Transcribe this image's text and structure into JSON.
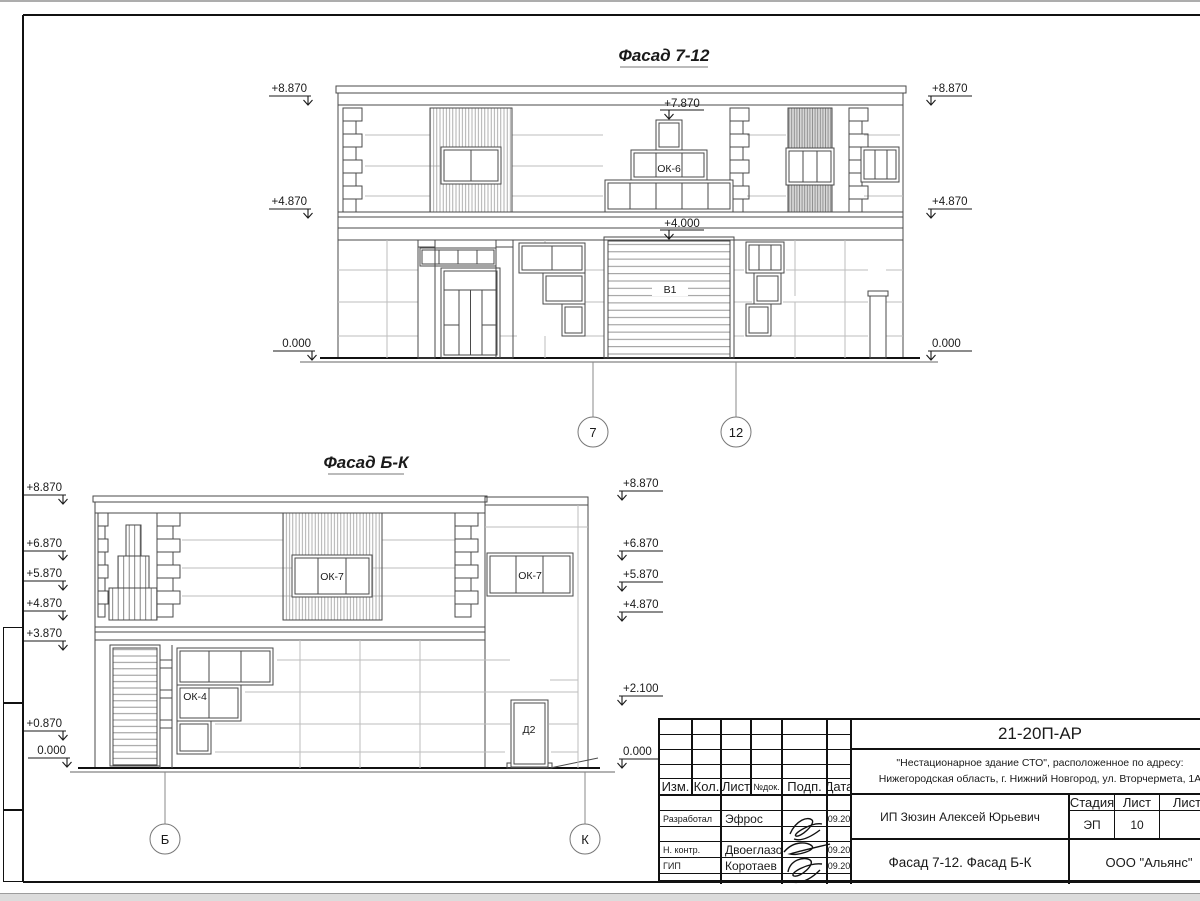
{
  "sheet": {
    "facade_7_12": {
      "title": "Фасад 7-12",
      "marks_left": [
        "+8.870",
        "+4.870",
        "0.000"
      ],
      "marks_right": [
        "+8.870",
        "+4.870",
        "0.000"
      ],
      "marks_mid": [
        "+7.870",
        "+4.000"
      ],
      "labels": {
        "window_pyramid": "ОК-6",
        "gate": "В1"
      },
      "axes": [
        "7",
        "12"
      ]
    },
    "facade_b_k": {
      "title": "Фасад Б-К",
      "marks_left": [
        "+8.870",
        "+6.870",
        "+5.870",
        "+4.870",
        "+3.870",
        "+0.870",
        "0.000"
      ],
      "marks_right": [
        "+8.870",
        "+6.870",
        "+5.870",
        "+4.870",
        "+2.100",
        "0.000"
      ],
      "labels": {
        "window_upper_1": "ОК-7",
        "window_upper_2": "ОК-7",
        "window_lower": "ОК-4",
        "door": "Д2"
      },
      "axes": [
        "Б",
        "К"
      ]
    },
    "title_block": {
      "doc_number": "21-20П-АР",
      "project_line1": "\"Нестационарное здание СТО\", расположенное по адресу:",
      "project_line2": "Нижегородская область, г. Нижний Новгород, ул. Вторчермета, 1А",
      "columns": {
        "izm": "Изм.",
        "kol": "Кол.",
        "list": "Лист",
        "ndok": "№док.",
        "podp": "Подп.",
        "data": "Дата"
      },
      "rows": [
        {
          "role": "Разработал",
          "name": "Эфрос",
          "date": "09.20"
        },
        {
          "role": "Н. контр.",
          "name": "Двоеглазов",
          "date": "09.20"
        },
        {
          "role": "ГИП",
          "name": "Коротаев",
          "date": "09.20"
        }
      ],
      "client": "ИП Зюзин Алексей Юрьевич",
      "stage_header": {
        "stage": "Стадия",
        "sheet": "Лист",
        "sheets": "Листов"
      },
      "stage_value": "ЭП",
      "sheet_value": "10",
      "sheet_title": "Фасад 7-12. Фасад Б-К",
      "company": "ООО \"Альянс\""
    }
  }
}
